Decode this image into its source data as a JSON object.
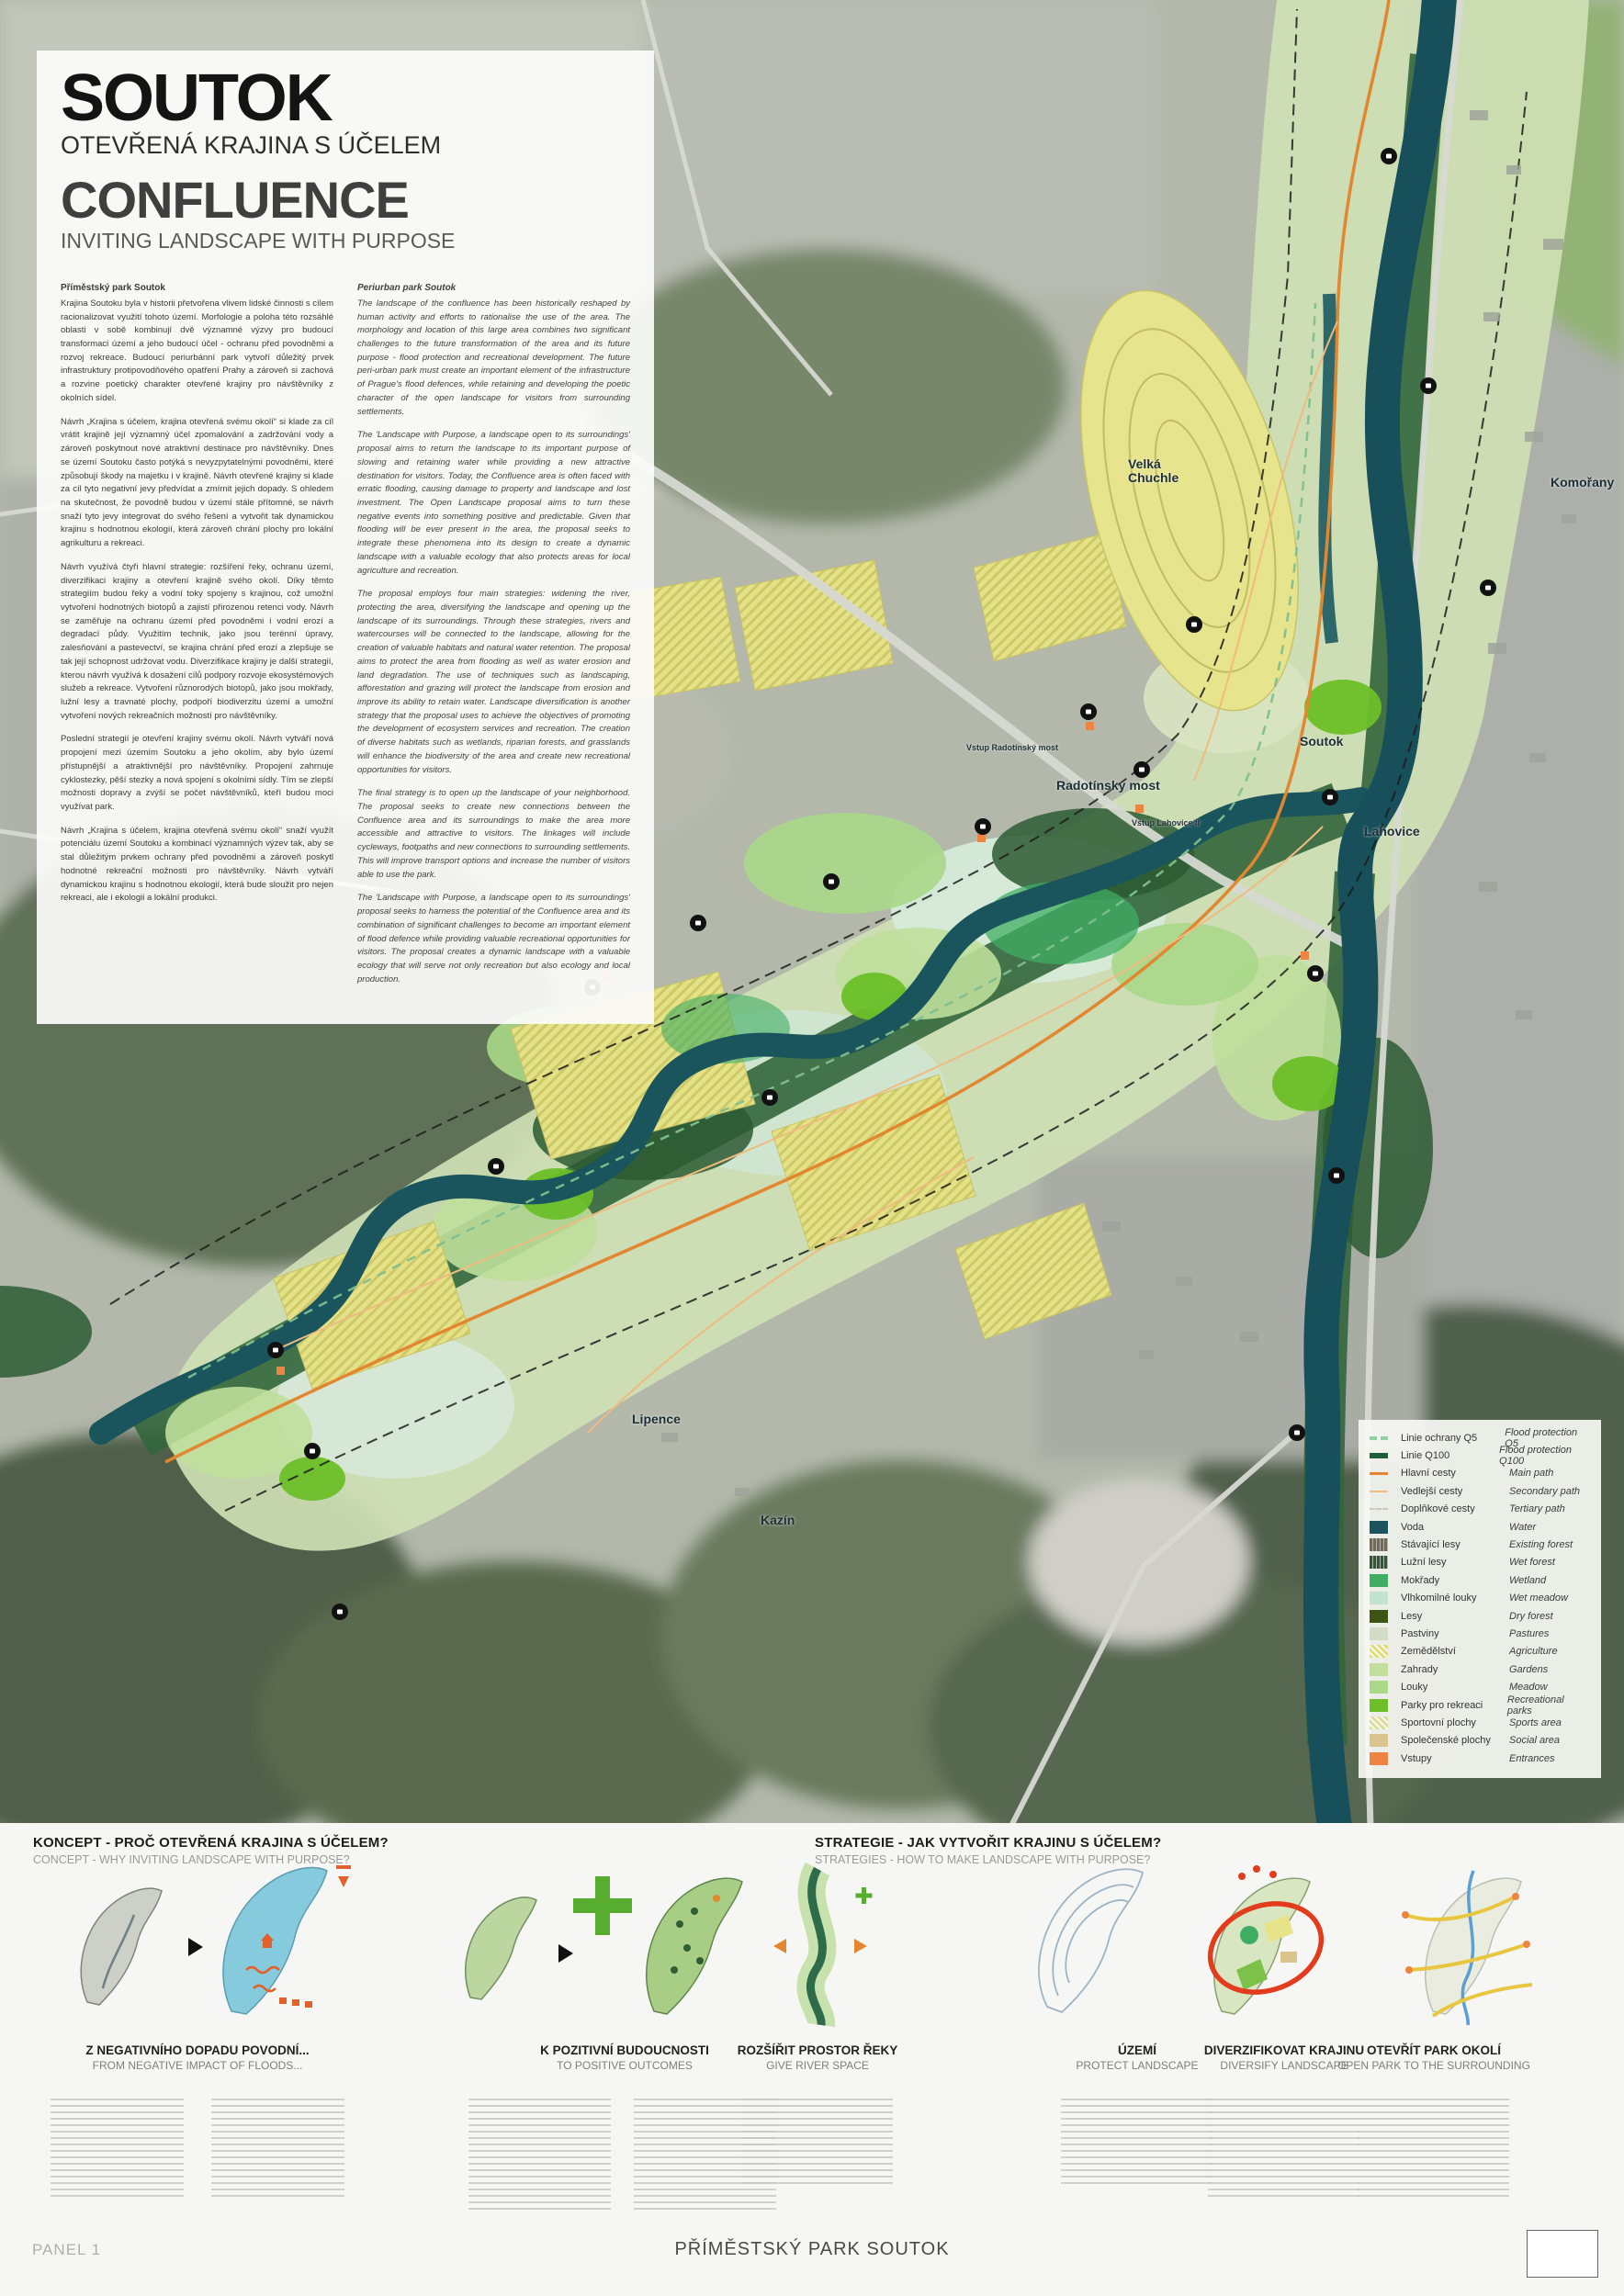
{
  "panel": {
    "title_cs": "SOUTOK",
    "subtitle_cs": "OTEVŘENÁ KRAJINA S ÚČELEM",
    "title_en": "CONFLUENCE",
    "subtitle_en": "INVITING LANDSCAPE WITH PURPOSE"
  },
  "intro": {
    "cs": {
      "heading": "Příměstský park Soutok",
      "paragraphs": [
        "Krajina Soutoku byla v historii přetvořena vlivem lidské činnosti s cílem racionalizovat využití tohoto území. Morfologie a poloha této rozsáhlé oblasti v sobě kombinují dvě významné výzvy pro budoucí transformaci území a jeho budoucí účel - ochranu před povodněmi a rozvoj rekreace. Budoucí periurbánní park vytvoří důležitý prvek infrastruktury protipovodňového opatření Prahy a zároveň si zachová a rozvine poetický charakter otevřené krajiny pro návštěvníky z okolních sídel.",
        "Návrh „Krajina s účelem, krajina otevřená svému okolí“ si klade za cíl vrátit krajině její významný účel zpomalování a zadržování vody a zároveň poskytnout nové atraktivní destinace pro návštěvníky. Dnes se území Soutoku často potýká s nevyzpytatelnými povodněmi, které způsobují škody na majetku i v krajině. Návrh otevřené krajiny si klade za cíl tyto negativní jevy předvídat a zmírnit jejich dopady. S ohledem na skutečnost, že povodně budou v území stále přítomné, se návrh snaží tyto jevy integrovat do svého řešení a vytvořit tak dynamickou krajinu s hodnotnou ekologií, která zároveň chrání plochy pro lokální agrikulturu a rekreaci.",
        "Návrh využívá čtyři hlavní strategie: rozšíření řeky, ochranu území, diverzifikaci krajiny a otevření krajině svého okolí. Díky těmto strategiím budou řeky a vodní toky spojeny s krajinou, což umožní vytvoření hodnotných biotopů a zajistí přirozenou retenci vody. Návrh se zaměřuje na ochranu území před povodněmi i vodní erozí a degradací půdy. Využitím technik, jako jsou terénní úpravy, zalesňování a pastevectví, se krajina chrání před erozí a zlepšuje se tak její schopnost udržovat vodu. Diverzifikace krajiny je další strategií, kterou návrh využívá k dosažení cílů podpory rozvoje ekosystémových služeb a rekreace. Vytvoření různorodých biotopů, jako jsou mokřady, lužní lesy a travnaté plochy, podpoří biodiverzitu území a umožní vytvoření nových rekreačních možností pro návštěvníky.",
        "Poslední strategií je otevření krajiny svému okolí. Návrh vytváří nová propojení mezi územím Soutoku a jeho okolím, aby bylo území přístupnější a atraktivnější pro návštěvníky. Propojení zahrnuje cyklostezky, pěší stezky a nová spojení s okolními sídly. Tím se zlepší možnosti dopravy a zvýší se počet návštěvníků, kteří budou moci využívat park.",
        "Návrh „Krajina s účelem, krajina otevřená svému okolí“ snaží využít potenciálu území Soutoku a kombinací významných výzev tak, aby se stal důležitým prvkem ochrany před povodněmi a zároveň poskytl hodnotné rekreační možnosti pro návštěvníky. Návrh vytváří dynamickou krajinu s hodnotnou ekologií, která bude sloužit pro nejen rekreaci, ale i ekologii a lokální produkci."
      ]
    },
    "en": {
      "heading": "Periurban park Soutok",
      "paragraphs": [
        "The landscape of the confluence has been historically reshaped by human activity and efforts to rationalise the use of the area. The morphology and location of this large area combines two significant challenges to the future transformation of the area and its future purpose - flood protection and recreational development. The future peri-urban park must create an important element of the infrastructure of Prague's flood defences, while retaining and developing the poetic character of the open landscape for visitors from surrounding settlements.",
        "The 'Landscape with Purpose, a landscape open to its surroundings' proposal aims to return the landscape to its important purpose of slowing and retaining water while providing a new attractive destination for visitors. Today, the Confluence area is often faced with erratic flooding, causing damage to property and landscape and lost investment. The Open Landscape proposal aims to turn these negative events into something positive and predictable. Given that flooding will be ever present in the area, the proposal seeks to integrate these phenomena into its design to create a dynamic landscape with a valuable ecology that also protects areas for local agriculture and recreation.",
        "The proposal employs four main strategies: widening the river, protecting the area, diversifying the landscape and opening up the landscape of its surroundings. Through these strategies, rivers and watercourses will be connected to the landscape, allowing for the creation of valuable habitats and natural water retention. The proposal aims to protect the area from flooding as well as water erosion and land degradation. The use of techniques such as landscaping, afforestation and grazing will protect the landscape from erosion and improve its ability to retain water. Landscape diversification is another strategy that the proposal uses to achieve the objectives of promoting the development of ecosystem services and recreation. The creation of diverse habitats such as wetlands, riparian forests, and grasslands will enhance the biodiversity of the area and create new recreational opportunities for visitors.",
        "The final strategy is to open up the landscape of your neighborhood. The proposal seeks to create new connections between the Confluence area and its surroundings to make the area more accessible and attractive to visitors. The linkages will include cycleways, footpaths and new connections to surrounding settlements. This will improve transport options and increase the number of visitors able to use the park.",
        "The 'Landscape with Purpose, a landscape open to its surroundings' proposal seeks to harness the potential of the Confluence area and its combination of significant challenges to become an important element of flood defence while providing valuable recreational opportunities for visitors. The proposal creates a dynamic landscape with a valuable ecology that will serve not only recreation but also ecology and local production."
      ]
    }
  },
  "map": {
    "labels": [
      {
        "text": "Velká Chuchle"
      },
      {
        "text": "Komořany"
      },
      {
        "text": "Soutok"
      },
      {
        "text": "Lahovice"
      },
      {
        "text": "Radotínský most"
      },
      {
        "text": "Vstup Radotínský most"
      },
      {
        "text": "Vstup Lahovice II"
      },
      {
        "text": "Lipence"
      },
      {
        "text": "Kazín"
      }
    ],
    "colors": {
      "water": "#1b545c",
      "main_path": "#e2862f",
      "agriculture": "#e0dc74",
      "recreational_park": "#6cbf28",
      "entrance": "#ed8441"
    }
  },
  "legend": {
    "items": [
      {
        "cs": "Linie ochrany Q5",
        "en": "Flood protection Q5",
        "kind": "line-dashed",
        "color": "#8fd4a0"
      },
      {
        "cs": "Linie Q100",
        "en": "Flood protection Q100",
        "kind": "line-dashed-thick",
        "color": "#1f5e38"
      },
      {
        "cs": "Hlavní cesty",
        "en": "Main path",
        "kind": "line",
        "color": "#e2862f"
      },
      {
        "cs": "Vedlejší cesty",
        "en": "Secondary path",
        "kind": "line-thin",
        "color": "#f0bb80"
      },
      {
        "cs": "Doplňkové cesty",
        "en": "Tertiary path",
        "kind": "line-dashed-thin",
        "color": "#cfc8b4"
      },
      {
        "cs": "Voda",
        "en": "Water",
        "kind": "fill",
        "color": "#1b545c"
      },
      {
        "cs": "Stávající lesy",
        "en": "Existing forest",
        "kind": "fill-texture",
        "color": "#77694f"
      },
      {
        "cs": "Lužní lesy",
        "en": "Wet forest",
        "kind": "fill-texture",
        "color": "#2c5a33"
      },
      {
        "cs": "Mokřady",
        "en": "Wetland",
        "kind": "fill",
        "color": "#3fae62"
      },
      {
        "cs": "Vlhkomilné louky",
        "en": "Wet meadow",
        "kind": "fill",
        "color": "#c2e3cd"
      },
      {
        "cs": "Lesy",
        "en": "Dry forest",
        "kind": "fill",
        "color": "#3c5414"
      },
      {
        "cs": "Pastviny",
        "en": "Pastures",
        "kind": "fill",
        "color": "#d3dcc6"
      },
      {
        "cs": "Zemědělství",
        "en": "Agriculture",
        "kind": "fill-hatch",
        "color": "#e0dc74"
      },
      {
        "cs": "Zahrady",
        "en": "Gardens",
        "kind": "fill",
        "color": "#bfdf9b"
      },
      {
        "cs": "Louky",
        "en": "Meadow",
        "kind": "fill",
        "color": "#a9d888"
      },
      {
        "cs": "Parky pro rekreaci",
        "en": "Recreational parks",
        "kind": "fill",
        "color": "#6cbf28"
      },
      {
        "cs": "Sportovní plochy",
        "en": "Sports area",
        "kind": "fill-hatch",
        "color": "#dcdc96"
      },
      {
        "cs": "Společenské plochy",
        "en": "Social area",
        "kind": "fill",
        "color": "#dbc48e"
      },
      {
        "cs": "Vstupy",
        "en": "Entrances",
        "kind": "fill",
        "color": "#ed8441"
      }
    ]
  },
  "sections": {
    "koncept": {
      "cs": "KONCEPT - PROČ OTEVŘENÁ KRAJINA S ÚČELEM?",
      "en": "CONCEPT - WHY INVITING LANDSCAPE WITH PURPOSE?"
    },
    "strategie": {
      "cs": "STRATEGIE - JAK VYTVOŘIT KRAJINU S ÚČELEM?",
      "en": "STRATEGIES - HOW TO MAKE LANDSCAPE WITH PURPOSE?"
    }
  },
  "diagrams": [
    {
      "title_cs": "Z NEGATIVNÍHO DOPADU POVODNÍ...",
      "title_en": "FROM NEGATIVE IMPACT OF FLOODS..."
    },
    {
      "title_cs": "K POZITIVNÍ BUDOUCNOSTI",
      "title_en": "TO POSITIVE OUTCOMES"
    },
    {
      "title_cs": "ROZŠÍŘIT PROSTOR ŘEKY",
      "title_en": "GIVE RIVER SPACE"
    },
    {
      "title_cs": "ÚZEMÍ",
      "title_en": "PROTECT LANDSCAPE"
    },
    {
      "title_cs": "DIVERZIFIKOVAT KRAJINU",
      "title_en": "DIVERSIFY LANDSCAPE"
    },
    {
      "title_cs": "OTEVŘÍT PARK OKOLÍ",
      "title_en": "OPEN PARK TO THE SURROUNDING"
    }
  ],
  "footer": {
    "panel_label": "PANEL 1",
    "project_title": "PŘÍMĚSTSKÝ PARK SOUTOK"
  }
}
